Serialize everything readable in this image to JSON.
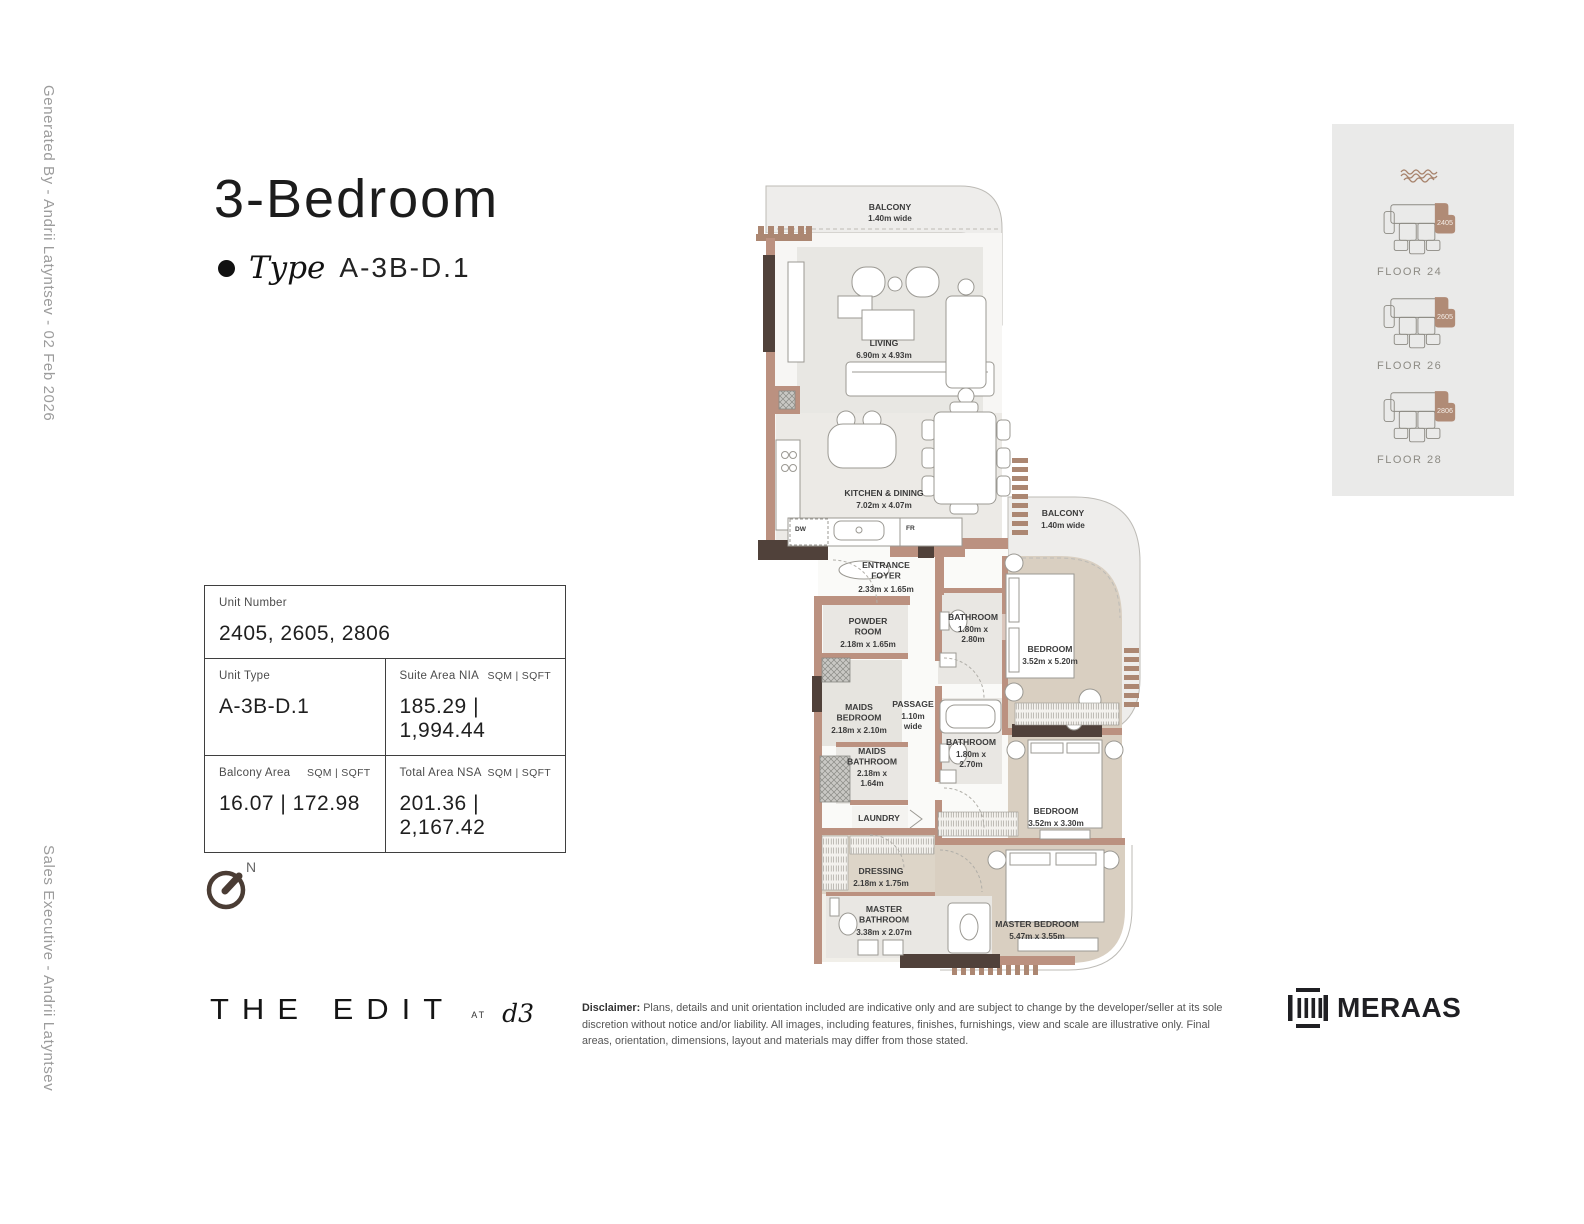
{
  "sidebar": {
    "generated_by": "Generated By - Andrii Latyntsev - 02 Feb 2026",
    "sales_executive": "Sales Executive - Andrii Latyntsev"
  },
  "header": {
    "title": "3-Bedroom",
    "type_label": "Type",
    "type_value": "A-3B-D.1"
  },
  "unit_table": {
    "unit_number": {
      "label": "Unit Number",
      "value": "2405, 2605, 2806"
    },
    "unit_type": {
      "label": "Unit Type",
      "value": "A-3B-D.1"
    },
    "suite_area": {
      "label": "Suite Area NIA",
      "units": "SQM | SQFT",
      "value": "185.29 | 1,994.44"
    },
    "balcony_area": {
      "label": "Balcony Area",
      "units": "SQM | SQFT",
      "value": "16.07 | 172.98"
    },
    "total_area": {
      "label": "Total Area NSA",
      "units": "SQM | SQFT",
      "value": "201.36 | 2,167.42"
    }
  },
  "compass": {
    "north": "N"
  },
  "plan": {
    "balcony_top": {
      "name": "BALCONY",
      "dims": "1.40m wide"
    },
    "living": {
      "name": "LIVING",
      "dims": "6.90m x 4.93m"
    },
    "kitchen": {
      "name": "KITCHEN & DINING",
      "dims": "7.02m x 4.07m"
    },
    "foyer": {
      "name": "ENTRANCE\nFOYER",
      "dims": "2.33m x 1.65m"
    },
    "balcony_right": {
      "name": "BALCONY",
      "dims": "1.40m wide"
    },
    "powder": {
      "name": "POWDER\nROOM",
      "dims": "2.18m x 1.65m"
    },
    "bathroom1": {
      "name": "BATHROOM",
      "dims": "1.80m x\n2.80m"
    },
    "bedroom1": {
      "name": "BEDROOM",
      "dims": "3.52m x 5.20m"
    },
    "maids_bedroom": {
      "name": "MAIDS\nBEDROOM",
      "dims": "2.18m x 2.10m"
    },
    "passage": {
      "name": "PASSAGE",
      "dims": "1.10m\nwide"
    },
    "bathroom2": {
      "name": "BATHROOM",
      "dims": "1.80m x\n2.70m"
    },
    "bedroom2": {
      "name": "BEDROOM",
      "dims": "3.52m x 3.30m"
    },
    "maids_bathroom": {
      "name": "MAIDS\nBATHROOM",
      "dims": "2.18m x\n1.64m"
    },
    "laundry": {
      "name": "LAUNDRY"
    },
    "dressing": {
      "name": "DRESSING",
      "dims": "2.18m x 1.75m"
    },
    "master_bathroom": {
      "name": "MASTER\nBATHROOM",
      "dims": "3.38m x 2.07m"
    },
    "master_bedroom": {
      "name": "MASTER BEDROOM",
      "dims": "5.47m x 3.55m"
    },
    "appliances": {
      "dishwasher": "DW",
      "fridge": "FR"
    }
  },
  "floor_key": {
    "items": [
      {
        "unit": "2405",
        "floor": "FLOOR 24"
      },
      {
        "unit": "2605",
        "floor": "FLOOR 26"
      },
      {
        "unit": "2806",
        "floor": "FLOOR 28"
      }
    ]
  },
  "footer": {
    "disclaimer_label": "Disclaimer:",
    "disclaimer_line1": "Plans, details and unit orientation included are indicative only and are subject to change by the developer/seller at its sole discretion without notice and/or liability.",
    "disclaimer_line2": "All images, including features, finishes, furnishings, view and scale are illustrative only. Final areas, orientation, dimensions, layout and materials may differ from those stated.",
    "brand_name": "THE EDIT",
    "brand_at": "AT",
    "brand_d3": "d3",
    "developer": "MERAAS"
  },
  "colors": {
    "wall_brown": "#bb9180",
    "wall_dark": "#50413a",
    "louvre_brown": "#ac8772",
    "bedroom_fill": "#d9cfc1",
    "balcony_fill": "#eeedeb",
    "panel_gray": "#eaeae9",
    "unit_highlight": "#b08b76",
    "muted_text": "#9c9c9c"
  }
}
